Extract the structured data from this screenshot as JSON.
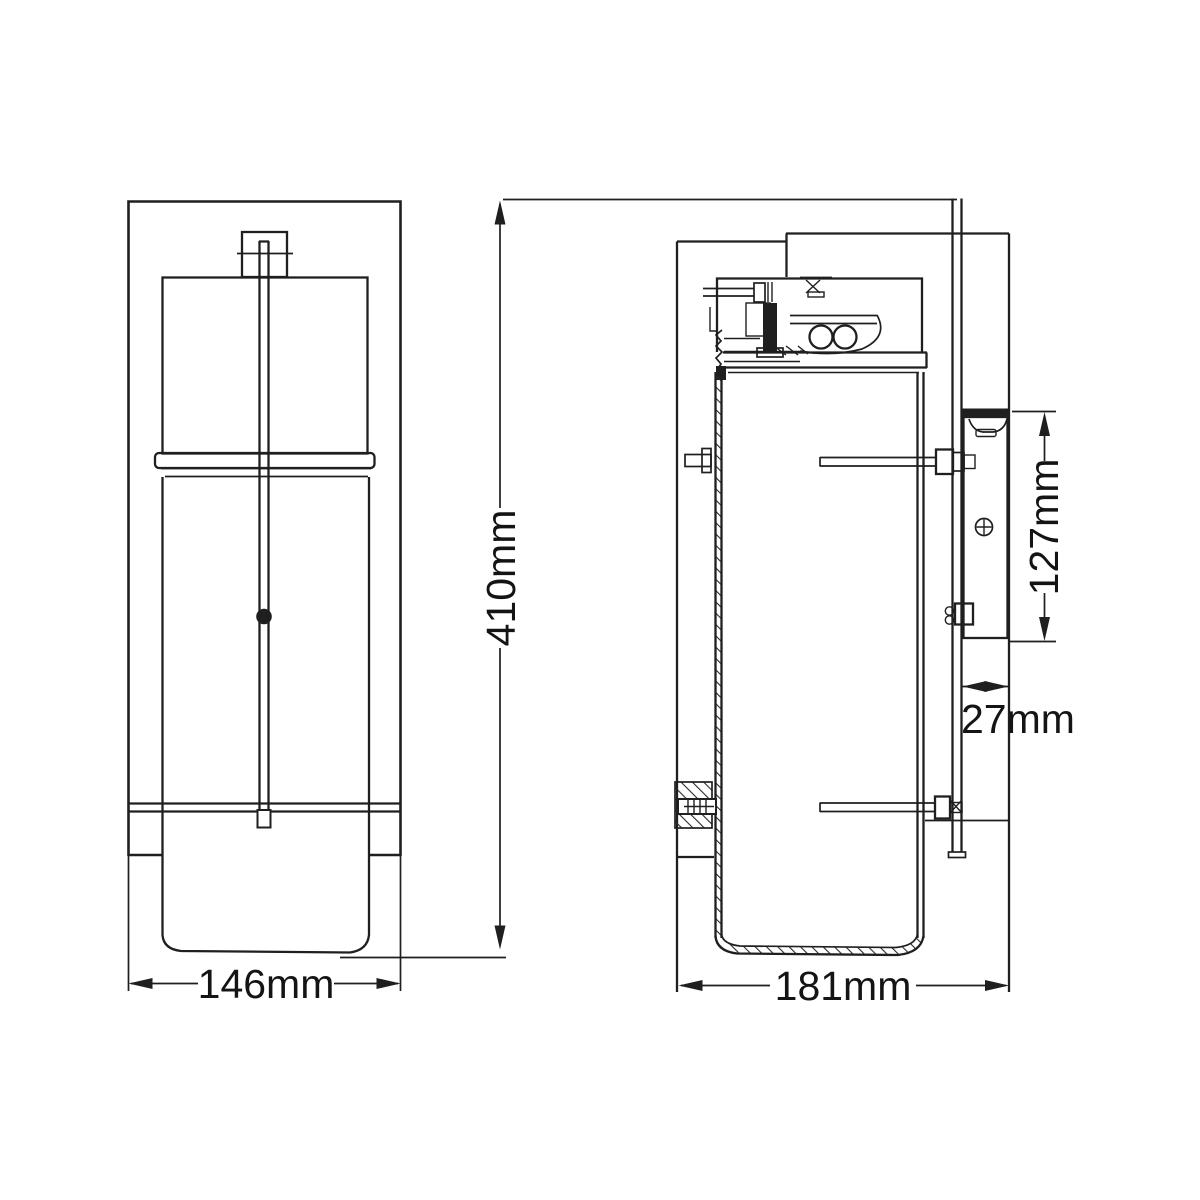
{
  "drawing": {
    "background": "#ffffff",
    "line_color": "#1f1f1f",
    "dimensions": {
      "front_width": "146mm",
      "overall_height": "410mm",
      "side_depth": "181mm",
      "bracket_height": "127mm",
      "bracket_offset": "27mm"
    }
  }
}
